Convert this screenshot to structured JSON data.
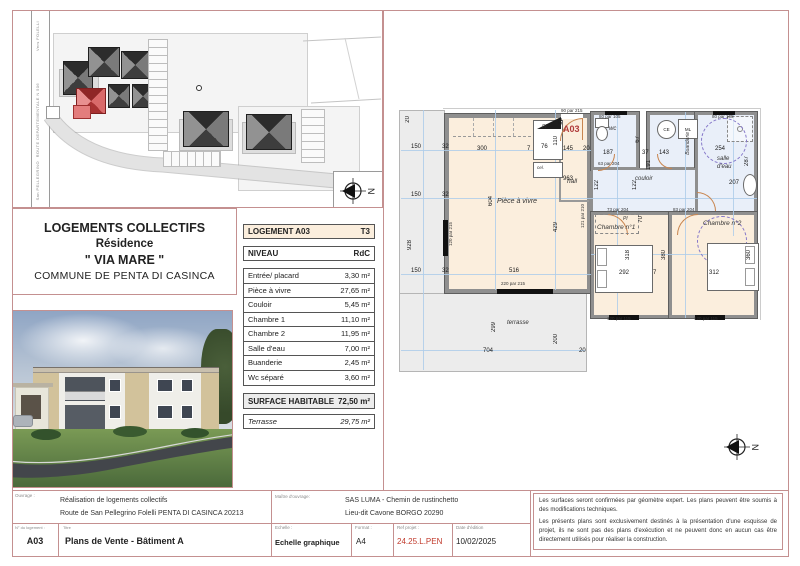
{
  "colors": {
    "frame_pink": "#c49090",
    "accent_red": "#b03a3a",
    "ref_red": "#c0392b",
    "room_cream": "#fbeedd",
    "room_blue": "#e9eff9",
    "terrace_gray": "#ececec",
    "highlight_red": "#d96060"
  },
  "site_plan": {
    "road_label_top": "Vers FOLELLI",
    "road_label_mid": "ROUTE DEPARTEMENTALE N 506",
    "road_label_bottom": "San PELLEGRINO",
    "north_label": "N"
  },
  "project": {
    "line1": "LOGEMENTS COLLECTIFS",
    "line2": "Résidence",
    "line3": "\" VIA MARE \"",
    "line4": "COMMUNE DE PENTA DI CASINCA"
  },
  "unit_table": {
    "header": {
      "label": "LOGEMENT A03",
      "value": "T3"
    },
    "level": {
      "label": "NIVEAU",
      "value": "RdC"
    },
    "rooms": [
      {
        "label": "Entrée/ placard",
        "value": "3,30 m²"
      },
      {
        "label": "Pièce à vivre",
        "value": "27,65 m²"
      },
      {
        "label": "Couloir",
        "value": "5,45 m²"
      },
      {
        "label": "Chambre 1",
        "value": "11,10 m²"
      },
      {
        "label": "Chambre 2",
        "value": "11,95 m²"
      },
      {
        "label": "Salle d'eau",
        "value": "7,00 m²"
      },
      {
        "label": "Buanderie",
        "value": "2,45 m²"
      },
      {
        "label": "Wc séparé",
        "value": "3,60 m²"
      }
    ],
    "total": {
      "label": "SURFACE HABITABLE",
      "value": "72,50 m²"
    },
    "terrace": {
      "label": "Terrasse",
      "value": "29,75 m²"
    }
  },
  "floor_plan": {
    "unit_label": "A03",
    "north_label": "N",
    "labels": {
      "living": "Pièce à vivre",
      "hall": "hall",
      "wc": "wc",
      "buanderie": "Buanderie",
      "salle_eau_1": "salle",
      "salle_eau_2": "d'eau",
      "couloir": "couloir",
      "ch1": "Chambre n°1",
      "ch2": "Chambre n°2",
      "terrasse": "terrasse",
      "pl": "Pl",
      "pl2": "Pl",
      "cel": "cel.",
      "ce": "CE",
      "ml": "ML"
    },
    "dims": [
      {
        "t": "20",
        "x": 10,
        "y": 12,
        "v": 1
      },
      {
        "t": "150",
        "x": 16,
        "y": 40
      },
      {
        "t": "32",
        "x": 47,
        "y": 40
      },
      {
        "t": "150",
        "x": 16,
        "y": 88
      },
      {
        "t": "32",
        "x": 47,
        "y": 88
      },
      {
        "t": "928",
        "x": 12,
        "y": 136,
        "v": 1
      },
      {
        "t": "150",
        "x": 16,
        "y": 164
      },
      {
        "t": "32",
        "x": 47,
        "y": 164
      },
      {
        "t": "300",
        "x": 82,
        "y": 42
      },
      {
        "t": "7",
        "x": 132,
        "y": 42
      },
      {
        "t": "76",
        "x": 146,
        "y": 40
      },
      {
        "t": "110",
        "x": 158,
        "y": 32,
        "v": 1
      },
      {
        "t": "145",
        "x": 168,
        "y": 42
      },
      {
        "t": "20",
        "x": 188,
        "y": 42
      },
      {
        "t": "33",
        "x": 163,
        "y": 14,
        "v": 1
      },
      {
        "t": "963",
        "x": 168,
        "y": 72
      },
      {
        "t": "604",
        "x": 93,
        "y": 92,
        "v": 1
      },
      {
        "t": "429",
        "x": 158,
        "y": 118,
        "v": 1
      },
      {
        "t": "516",
        "x": 114,
        "y": 164
      },
      {
        "t": "704",
        "x": 88,
        "y": 244
      },
      {
        "t": "299",
        "x": 96,
        "y": 218,
        "v": 1
      },
      {
        "t": "200",
        "x": 158,
        "y": 230,
        "v": 1
      },
      {
        "t": "20",
        "x": 184,
        "y": 244
      },
      {
        "t": "187",
        "x": 208,
        "y": 46
      },
      {
        "t": "67",
        "x": 240,
        "y": 32,
        "v": 1
      },
      {
        "t": "37",
        "x": 247,
        "y": 46
      },
      {
        "t": "143",
        "x": 264,
        "y": 46
      },
      {
        "t": "191",
        "x": 251,
        "y": 56,
        "v": 1
      },
      {
        "t": "254",
        "x": 320,
        "y": 42
      },
      {
        "t": "287",
        "x": 349,
        "y": 52,
        "v": 1
      },
      {
        "t": "207",
        "x": 334,
        "y": 76
      },
      {
        "t": "122",
        "x": 199,
        "y": 76,
        "v": 1
      },
      {
        "t": "122",
        "x": 237,
        "y": 76,
        "v": 1
      },
      {
        "t": "70",
        "x": 243,
        "y": 112,
        "v": 1
      },
      {
        "t": "318",
        "x": 230,
        "y": 146,
        "v": 1
      },
      {
        "t": "292",
        "x": 224,
        "y": 166
      },
      {
        "t": "7",
        "x": 258,
        "y": 166
      },
      {
        "t": "380",
        "x": 266,
        "y": 146,
        "v": 1
      },
      {
        "t": "312",
        "x": 314,
        "y": 166
      },
      {
        "t": "360",
        "x": 351,
        "y": 146,
        "v": 1
      }
    ],
    "openings": [
      {
        "t": "90 par 215",
        "x": 166,
        "y": 5
      },
      {
        "t": "80 par 105",
        "x": 204,
        "y": 11
      },
      {
        "t": "80 par 105",
        "x": 317,
        "y": 11
      },
      {
        "t": "63 par 204",
        "x": 203,
        "y": 58
      },
      {
        "t": "121 par 210",
        "x": 186,
        "y": 100,
        "v": 1
      },
      {
        "t": "73 par 204",
        "x": 212,
        "y": 104
      },
      {
        "t": "83 par 204",
        "x": 278,
        "y": 104
      },
      {
        "t": "120 par 215",
        "x": 54,
        "y": 118,
        "v": 1
      },
      {
        "t": "220 par 215",
        "x": 106,
        "y": 178
      },
      {
        "t": "120 par 115",
        "x": 212,
        "y": 213
      },
      {
        "t": "120 par 115",
        "x": 299,
        "y": 213
      }
    ]
  },
  "title_block": {
    "ouvrage_label": "Ouvrage :",
    "ouvrage_line1": "Réalisation de logements collectifs",
    "ouvrage_line2": "Route de San Pellegrino Folelli PENTA DI CASINCA 20213",
    "num_label": "N° du logement :",
    "num_value": "A03",
    "titre_label": "Titre",
    "titre_value": "Plans de Vente - Bâtiment A",
    "moa_label": "Maître d'ouvrage:",
    "moa_line1": "SAS LUMA - Chemin de rustinchetto",
    "moa_line2": "Lieu-dit Cavone BORGO 20290",
    "echelle_label": "Echelle :",
    "echelle_value": "Echelle graphique",
    "format_label": "Format :",
    "format_value": "A4",
    "ref_label": "Ref projet :",
    "ref_value": "24.25.L.PEN",
    "date_label": "Date d'édition",
    "date_value": "10/02/2025",
    "disclaimer_1": "Les surfaces seront confirmées par géomètre expert. Les plans peuvent être soumis à des modifications techniques.",
    "disclaimer_2": "Les présents plans sont exclusivement destinés à la présentation d'une esquisse de projet, ils ne sont pas des plans d'exécution et ne peuvent donc en aucun cas être directement utilisés pour réaliser la construction."
  }
}
